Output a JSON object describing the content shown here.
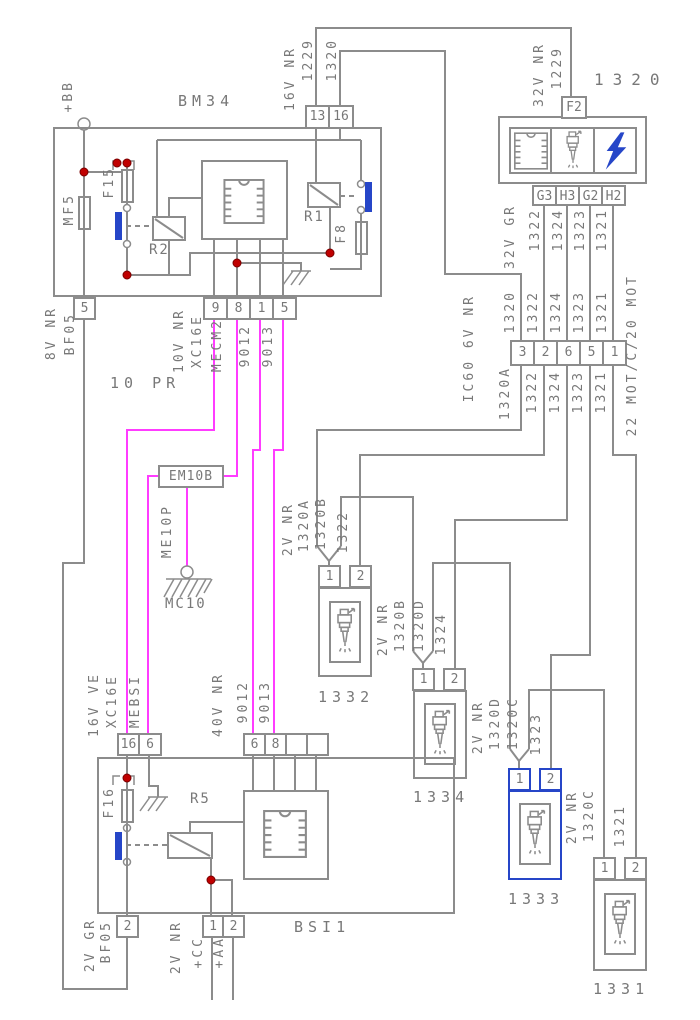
{
  "colors": {
    "wire": "#8c8c8c",
    "magenta": "#ff3cff",
    "blue": "#2646c8",
    "junction": "#c00000",
    "text": "#787878"
  },
  "bm34": {
    "title": "BM34",
    "plus_bb": "+BB",
    "mf5": "MF5",
    "f15": "F15",
    "r2": "R2",
    "r1": "R1",
    "f8": "F8",
    "conn_top": [
      "13",
      "16"
    ],
    "top_gauge": "16V NR",
    "top_w1": "1229",
    "top_w2": "1320",
    "pin5": "5",
    "pin5_gauge": "8V NR",
    "pin5_wire": "BF05",
    "conn_bottom": [
      "9",
      "8",
      "1",
      "5"
    ],
    "bot_gauge": "10V NR",
    "bot_w": [
      "XC16E",
      "MECM2",
      "9012",
      "9013"
    ],
    "note": "10 PR"
  },
  "relay_box": {
    "code": "1320",
    "fuse": "F2",
    "gauge": "32V NR",
    "wire": "1229",
    "conn": [
      "G3",
      "H3",
      "G2",
      "H2"
    ],
    "out_gauge": "32V GR",
    "out_wires": [
      "1322",
      "1324",
      "1323",
      "1321"
    ]
  },
  "ic60": {
    "label": "IC60 6V NR",
    "wires_above": [
      "1320",
      "1322",
      "1324",
      "1323",
      "1321"
    ],
    "pins": [
      "3",
      "2",
      "6",
      "5",
      "1"
    ],
    "wires_below": [
      "1320A",
      "1322",
      "1324",
      "1323",
      "1321"
    ],
    "harness": "22 MOT/C/20 MOT"
  },
  "grounds": {
    "splice": "EM10B",
    "wire": "ME10P",
    "ground": "MC10"
  },
  "injectors": [
    {
      "id": "1332",
      "gauge": "2V NR",
      "in": "1320A",
      "out": "1320B",
      "cmd": "1322",
      "pins": [
        "1",
        "2"
      ]
    },
    {
      "id": "1334",
      "gauge": "2V NR",
      "in": "1320B",
      "out": "1320D",
      "cmd": "1324",
      "pins": [
        "1",
        "2"
      ]
    },
    {
      "id": "1333",
      "gauge": "2V NR",
      "in": "1320D",
      "out": "1320C",
      "cmd": "1323",
      "pins": [
        "1",
        "2"
      ]
    },
    {
      "id": "1331",
      "gauge": "2V NR",
      "in": "1320C",
      "cmd": "1321",
      "pins": [
        "1",
        "2"
      ]
    }
  ],
  "bsi": {
    "title": "BSI1",
    "f16": "F16",
    "r5": "R5",
    "conn_left_pins": [
      "16",
      "6"
    ],
    "left_gauge": "16V VE",
    "left_w1": "XC16E",
    "left_w2": "MEBSI",
    "conn_right_pins": [
      "6",
      "8",
      "",
      ""
    ],
    "right_gauge": "40V NR",
    "right_w1": "9012",
    "right_w2": "9013",
    "pin2": "2",
    "pin2_gauge": "2V GR",
    "pin2_wire": "BF05",
    "conn_bottom_pins": [
      "1",
      "2"
    ],
    "bottom_gauge": "2V NR",
    "bottom_w1": "+CC",
    "bottom_w2": "+AA"
  }
}
